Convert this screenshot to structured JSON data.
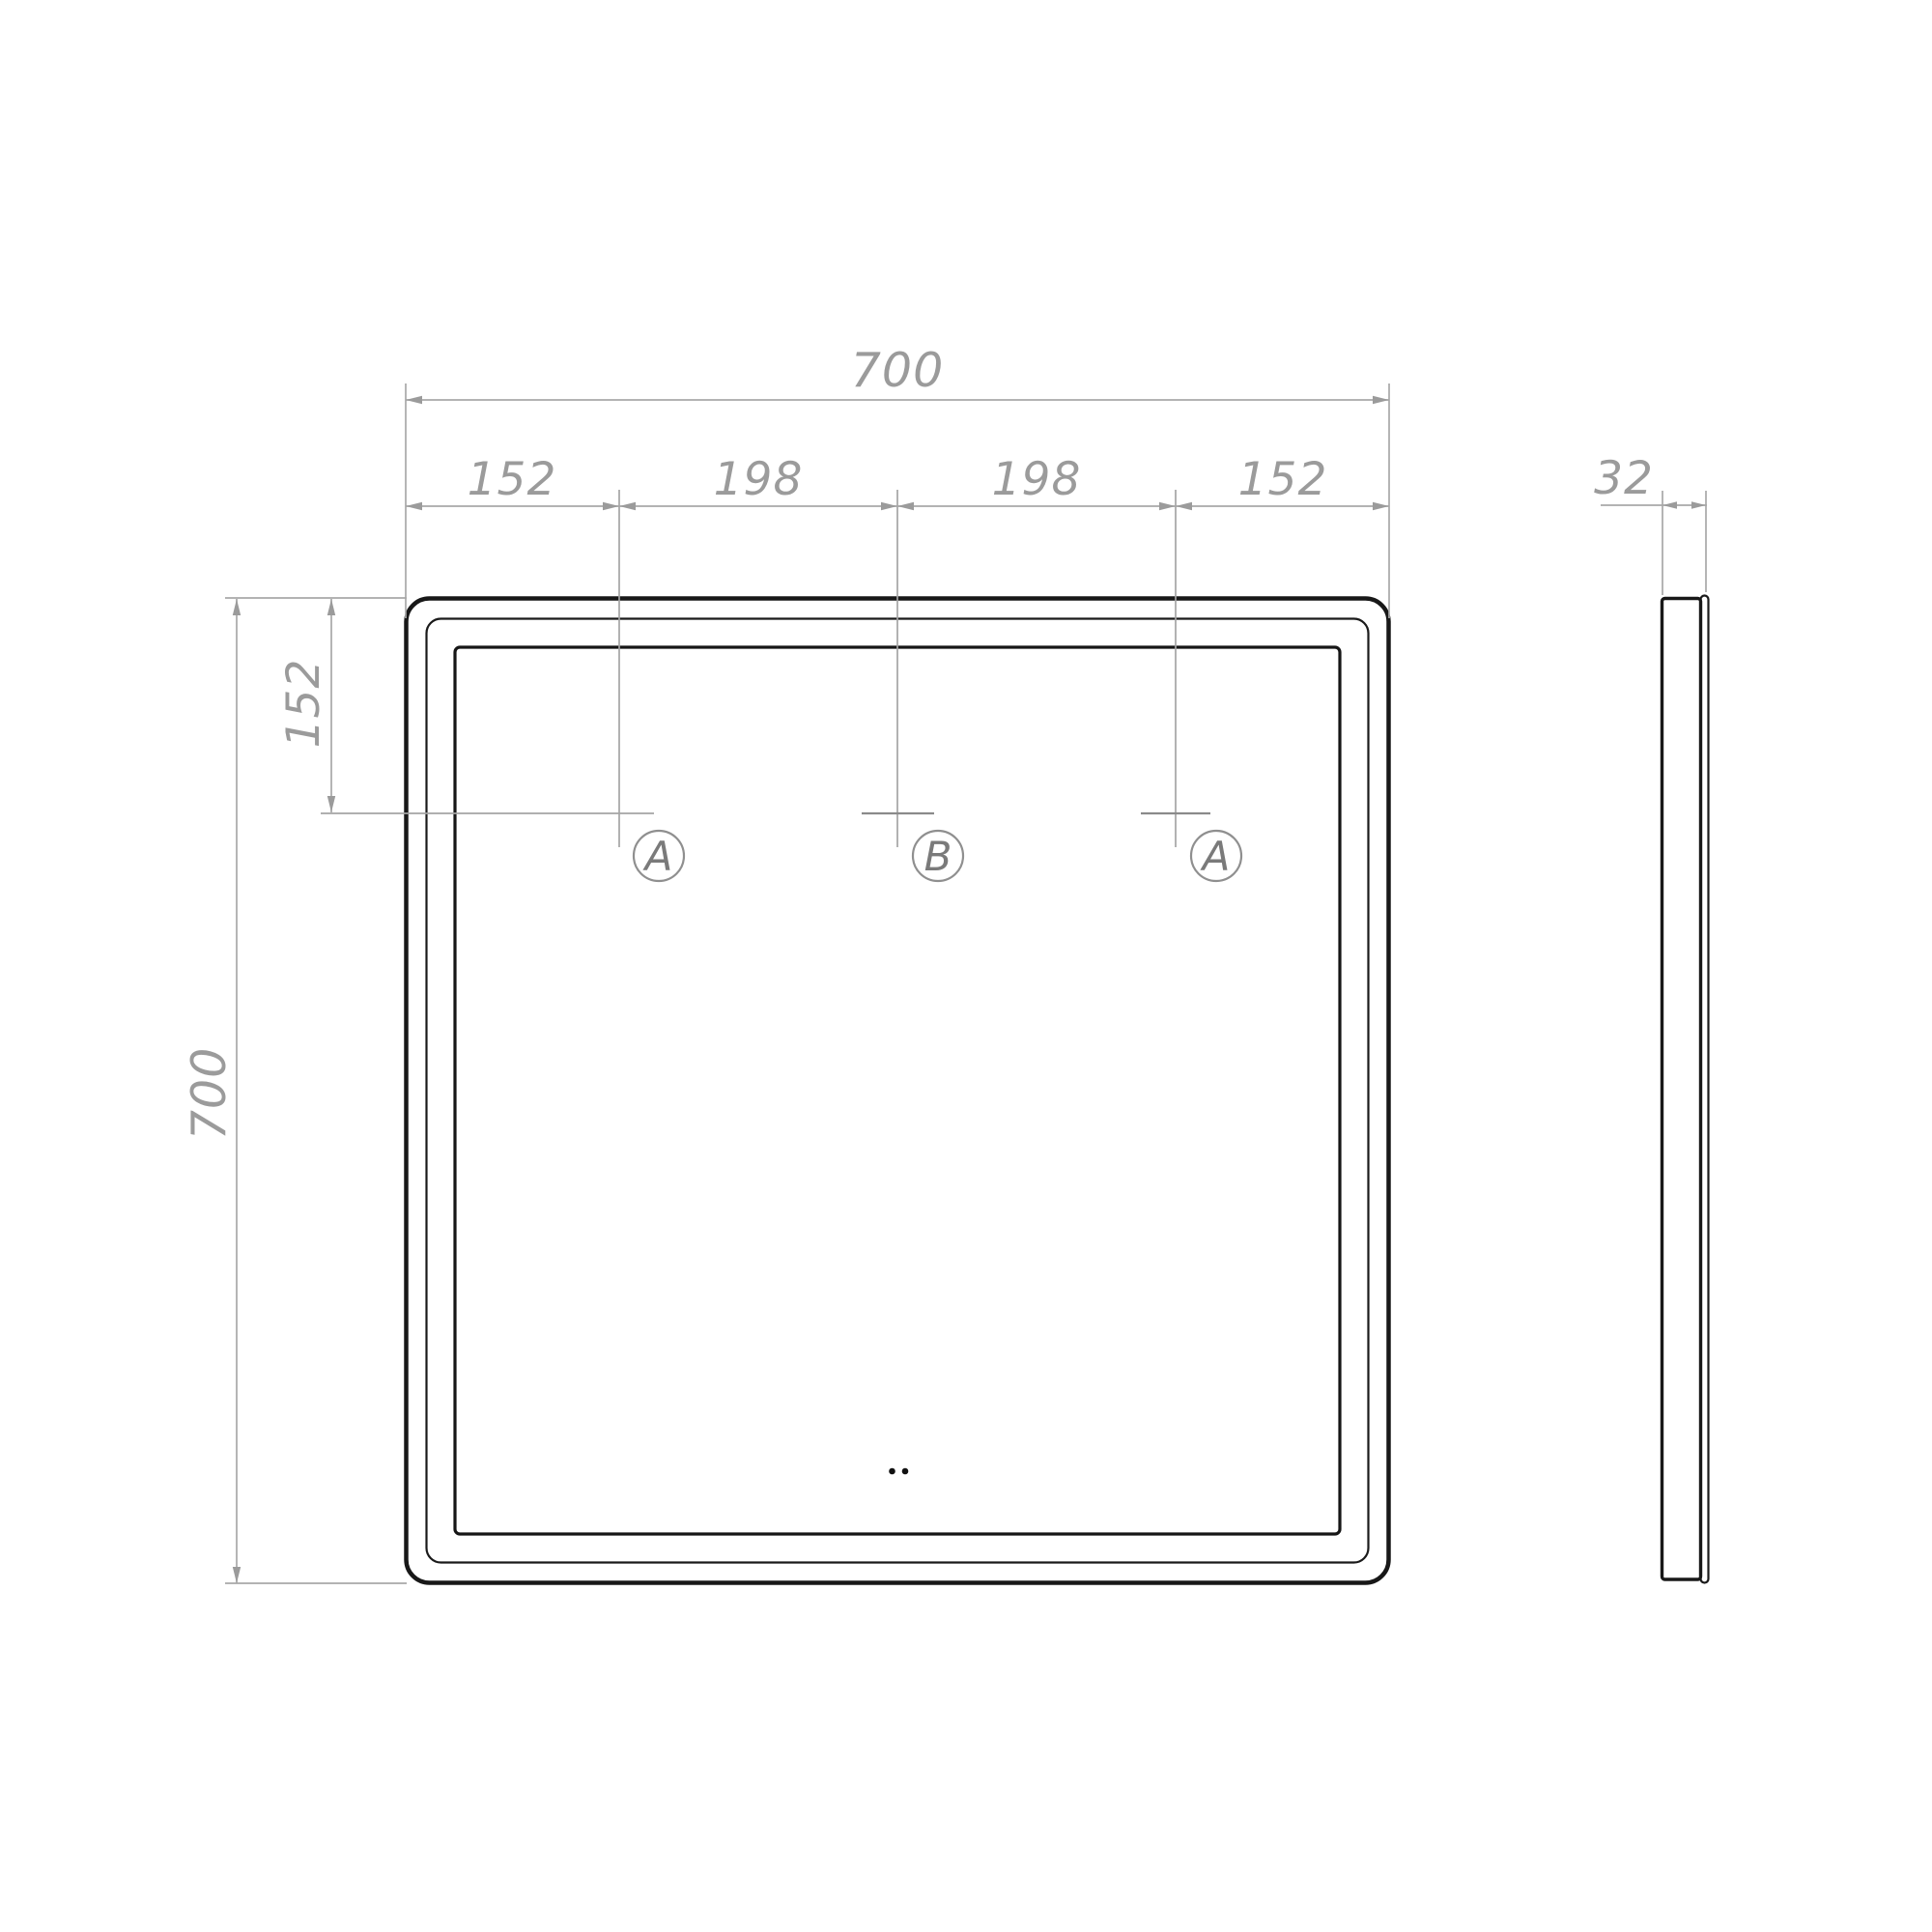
{
  "drawing": {
    "front_view": {
      "overall_width": "700",
      "overall_height": "700",
      "top_offset": "152",
      "segments": [
        "152",
        "198",
        "198",
        "152"
      ],
      "mount_labels": [
        "A",
        "B",
        "A"
      ]
    },
    "side_view": {
      "thickness": "32"
    },
    "colors": {
      "outline": "#1a1a1a",
      "dim_line": "#a8a8a8",
      "dim_text": "#9b9b9b",
      "marker": "#8a8a8a"
    }
  }
}
